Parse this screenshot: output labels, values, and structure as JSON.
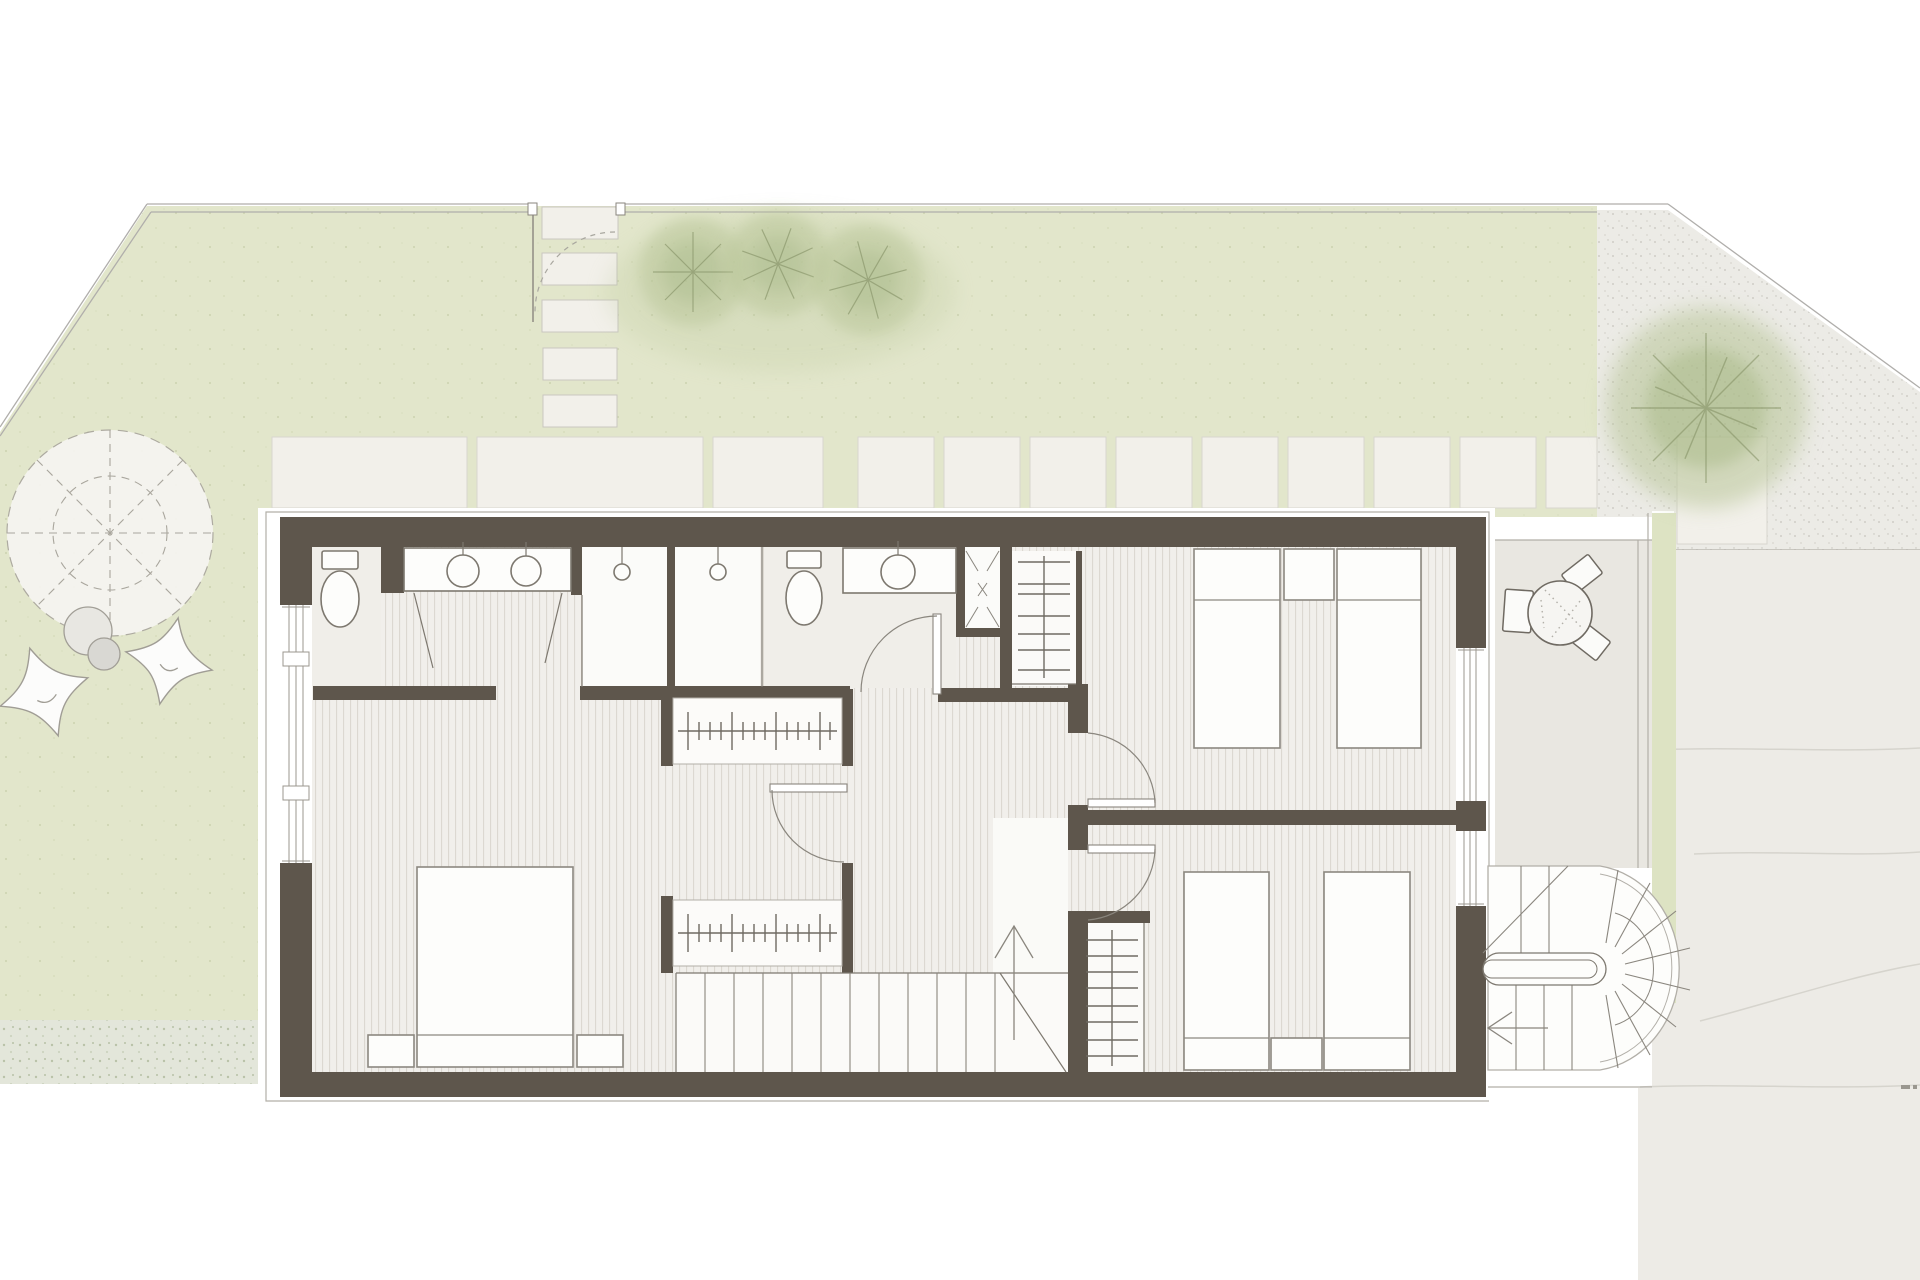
{
  "document": {
    "kind": "architectural floor plan",
    "content": "upper floor plan of a row house with garden, terrace and exterior spiral stair",
    "visible_text": "none — drawing contains no labels or dimensions",
    "style": "watercolor-tinted CAD plan"
  },
  "palette": {
    "background": "#ffffff",
    "lawn": "#e2e6cb",
    "wall": "#5e564c",
    "floor": "#f1efeb",
    "floor_stripe": "#dcd8d1",
    "paver": "#f2f0ea",
    "terrace": "#e9e7e1",
    "gravel": "#ecebe6",
    "driveway": "#edebe6",
    "line": "#7d786f",
    "thin_line": "#b2afa8",
    "tree": "#b7c496",
    "tree_branch": "#879468",
    "fixture": "#fdfdfb",
    "shrub": "#e3e6da",
    "green_strip": "#dde3c3"
  },
  "garden": {
    "stepping_stones": 5,
    "gate": {
      "type": "garden gate with dashed swing arc",
      "count": 1
    },
    "small_trees": 3,
    "large_tree": 1,
    "parasol_circle": {
      "style": "dashed circle with 8 dashed spokes and inner dashed ring"
    },
    "lounge_chairs": 2,
    "poufs": 2,
    "paver_slabs_large": 3,
    "paver_squares_small": 9,
    "gravel_area": true,
    "shrub_strip": true
  },
  "house": {
    "bathroom_zone": {
      "toilets": 2,
      "vanities": [
        {
          "sinks": 2
        },
        {
          "sinks": 1
        }
      ],
      "showers": 2,
      "service_shaft": {
        "symbol": "X"
      },
      "door_leaves_ajar": 2,
      "swing_door": 1
    },
    "master_bedroom": {
      "double_bed": 1,
      "nightstands": 2,
      "west_windows": 3
    },
    "dressing_area": {
      "wardrobe_rails": 2,
      "swing_door": 1
    },
    "hall": {
      "linen_closets": 2,
      "bedroom_doors": 2
    },
    "main_stair": {
      "treads": 12,
      "direction_arrow": "up",
      "landing": true
    },
    "bedroom_northeast": {
      "single_beds": 2,
      "nightstand": 1
    },
    "bedroom_southeast": {
      "single_beds": 2,
      "nightstand": 1
    },
    "east_windows": 2
  },
  "exterior": {
    "terrace": {
      "round_table": 1,
      "chairs": 3,
      "edge": "double line with planting strip"
    },
    "spiral_stair": {
      "flights": 2,
      "winder_fan_lines": 8,
      "direction_arrow": "left",
      "newel": "stadium-shaped island"
    },
    "driveway": {
      "joint_lines": 4
    },
    "corner_mark": 1
  }
}
